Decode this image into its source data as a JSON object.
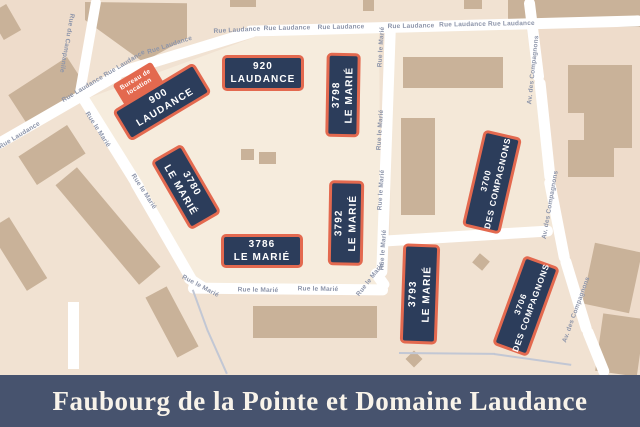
{
  "banner": {
    "title": "Faubourg de la Pointe et Domaine Laudance"
  },
  "office_tab": {
    "line1": "Bureau de",
    "line2": "location"
  },
  "buildings": [
    {
      "id": "900-laudance",
      "number": "900",
      "street": "LAUDANCE"
    },
    {
      "id": "920-laudance",
      "number": "920",
      "street": "LAUDANCE"
    },
    {
      "id": "3798-le-marie",
      "number": "3798",
      "street": "LE MARIÉ"
    },
    {
      "id": "3780-le-marie",
      "number": "3780",
      "street": "LE MARIÉ"
    },
    {
      "id": "3792-le-marie",
      "number": "3792",
      "street": "LE MARIÉ"
    },
    {
      "id": "3786-le-marie",
      "number": "3786",
      "street": "LE MARIÉ"
    },
    {
      "id": "3793-le-marie",
      "number": "3793",
      "street": "LE MARIÉ"
    },
    {
      "id": "3700-des-compagnons",
      "number": "3700",
      "street": "DES COMPAGNONS"
    },
    {
      "id": "3706-des-compagnons",
      "number": "3706",
      "street": "DES COMPAGNONS"
    }
  ],
  "streets": {
    "laudance": "Rue Laudance",
    "laudance_double": "Rue Laudance Rue Laudance",
    "campanile": "Rue du Campanile",
    "marie": "Rue le Marié",
    "compagnons": "Av. des Compagnons"
  },
  "colors": {
    "building_fill": "#2C3D5B",
    "building_border": "#E3694F",
    "office_tab_bg": "#E3694F",
    "road": "#FFFFFF",
    "map_base": "#F1E2D2",
    "block_light": "#F6ECDD",
    "block_shaded": "#EEDCCB",
    "unlabeled_building": "#C9B299",
    "street_label": "#8C94A9",
    "banner_bg": "#47536E",
    "banner_text": "#F8F3EA"
  }
}
